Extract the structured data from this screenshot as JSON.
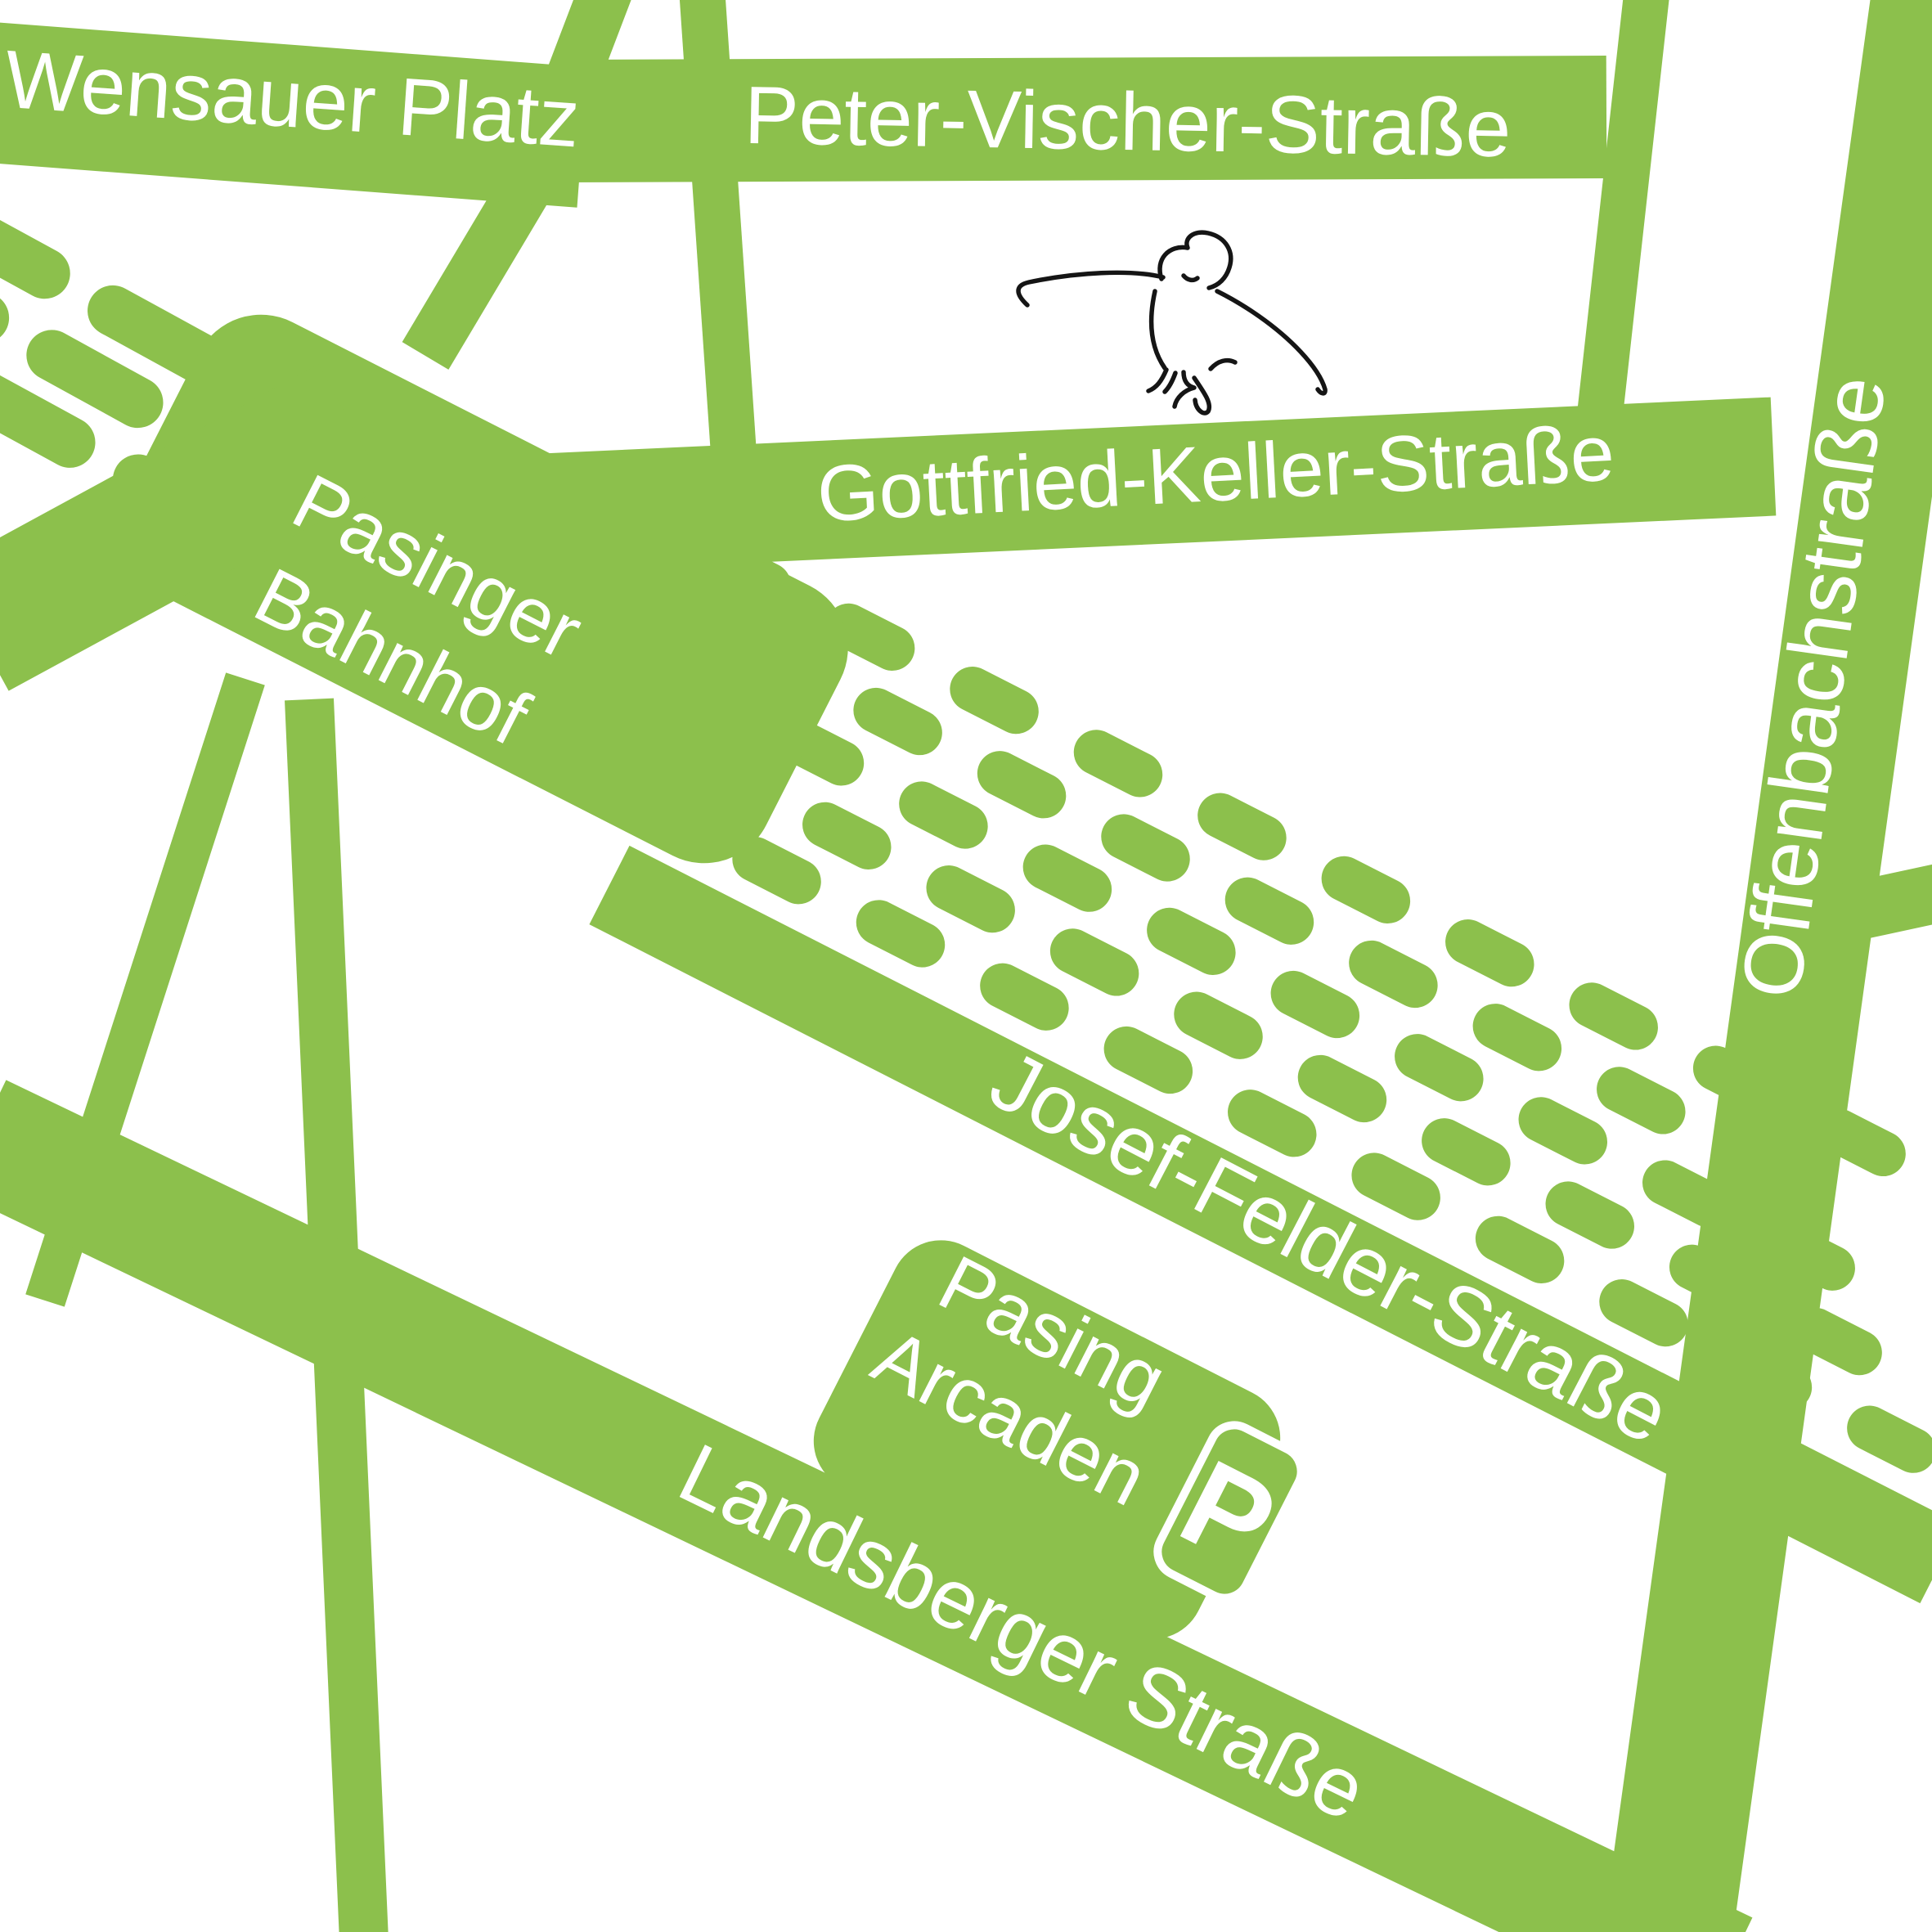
{
  "map": {
    "title": "Pasing area map",
    "colors": {
      "road_green": "#8CC04C",
      "label_white": "#FFFFFF",
      "sketch_black": "#151515",
      "background": "#FFFFFF"
    },
    "roads": {
      "wensauer_platz": "Wensauer Platz",
      "peter_vischer": "Peter-Vischer-Straße",
      "gottfried_keller": "Gottfried-Keller-Straße",
      "offenbachstrasse": "Offenbachstraße",
      "josef_felder": "Josef-Felder-Straße",
      "landsberger": "Landsberger Straße"
    },
    "places": {
      "station_line1": "Pasinger",
      "station_line2": "Bahnhof",
      "arcaden_line1": "Pasing",
      "arcaden_line2": "Arcaden",
      "parking_label": "P"
    },
    "icons": {
      "parking": "parking-icon",
      "bird": "bird-sketch-icon"
    }
  }
}
